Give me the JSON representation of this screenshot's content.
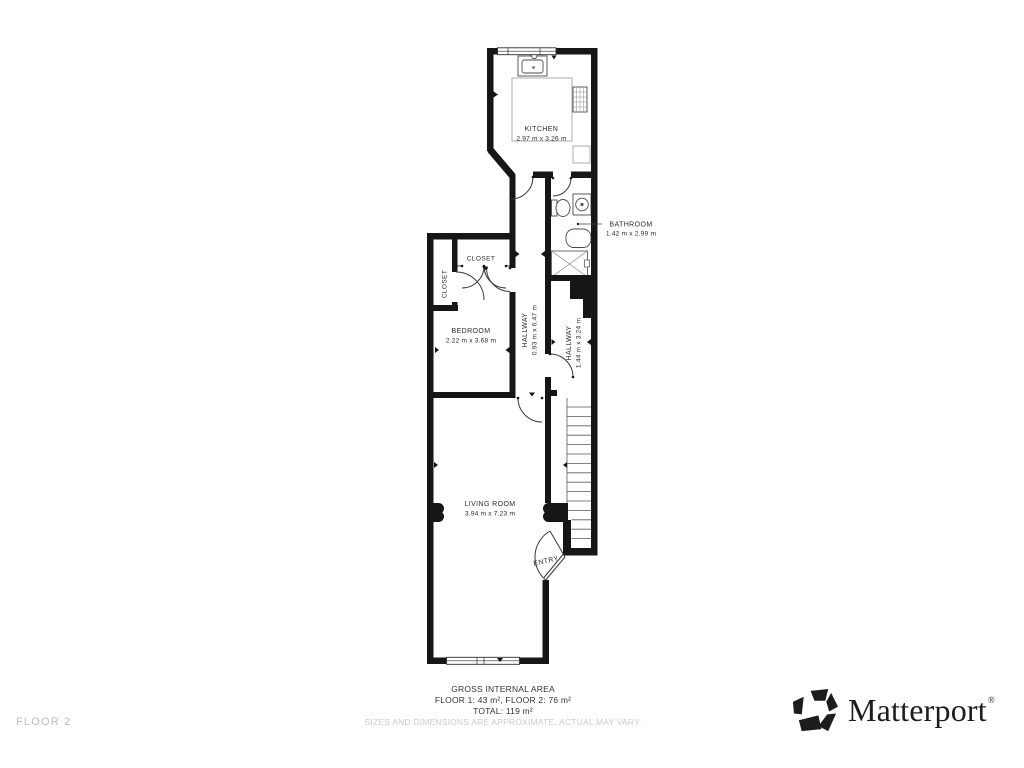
{
  "floorplan": {
    "wall_color": "#161616",
    "rooms": [
      {
        "id": "kitchen",
        "name": "KITCHEN",
        "dims": "2.97 m x 3.26 m"
      },
      {
        "id": "bathroom",
        "name": "BATHROOM",
        "dims": "1.42 m x 2.99 m"
      },
      {
        "id": "closet-left",
        "name": "CLOSET",
        "dims": ""
      },
      {
        "id": "closet-top",
        "name": "CLOSET",
        "dims": ""
      },
      {
        "id": "bedroom",
        "name": "BEDROOM",
        "dims": "2.22 m x 3.68 m"
      },
      {
        "id": "hallway-1",
        "name": "HALLWAY",
        "dims": "0.93 m x 6.47 m"
      },
      {
        "id": "hallway-2",
        "name": "HALLWAY",
        "dims": "1.44 m x 3.24 m"
      },
      {
        "id": "living-room",
        "name": "LIVING ROOM",
        "dims": "3.94 m x 7.23 m"
      },
      {
        "id": "entry",
        "name": "ENTRY",
        "dims": ""
      }
    ]
  },
  "footer": {
    "floor_label": "FLOOR 2",
    "gross_area_title": "GROSS INTERNAL AREA",
    "gross_area_line1": "FLOOR 1: 43 m², FLOOR 2: 76 m²",
    "gross_area_line2": "TOTAL: 119 m²",
    "disclaimer": "SIZES AND DIMENSIONS ARE APPROXIMATE, ACTUAL MAY VARY."
  },
  "branding": {
    "name": "Matterport",
    "registered_mark": "®"
  }
}
